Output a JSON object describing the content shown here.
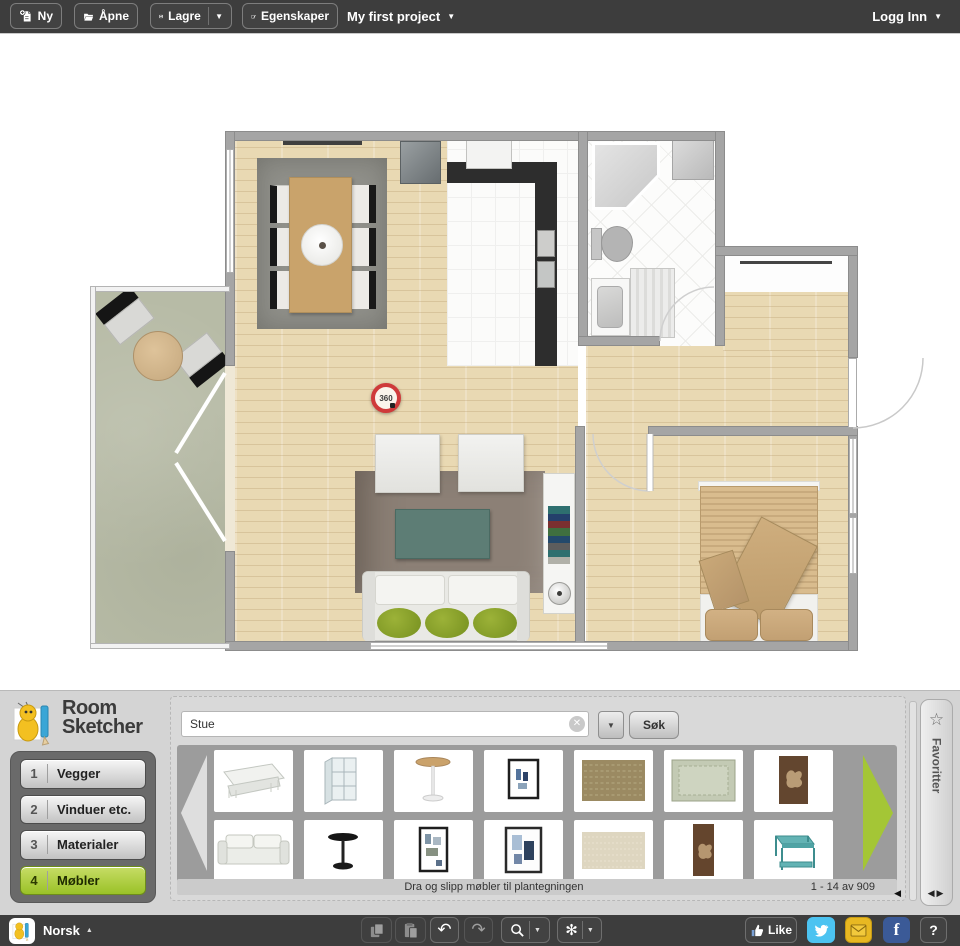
{
  "toolbar": {
    "new_label": "Ny",
    "open_label": "Åpne",
    "save_label": "Lagre",
    "properties_label": "Egenskaper",
    "project_name": "My first project",
    "login_label": "Logg Inn"
  },
  "plan": {
    "marker_360": "360"
  },
  "brand": {
    "name_line1": "Room",
    "name_line2": "Sketcher"
  },
  "menu": {
    "items": [
      {
        "number": "1",
        "label": "Vegger",
        "active": false
      },
      {
        "number": "2",
        "label": "Vinduer etc.",
        "active": false
      },
      {
        "number": "3",
        "label": "Materialer",
        "active": false
      },
      {
        "number": "4",
        "label": "Møbler",
        "active": true
      }
    ]
  },
  "library": {
    "search_value": "Stue",
    "search_button_label": "Søk",
    "drag_hint": "Dra og slipp møbler til plantegningen",
    "result_count": "1 - 14 av 909",
    "favorites_label": "Favoritter",
    "items": [
      {
        "kind": "coffee-table-white"
      },
      {
        "kind": "display-cabinet-white"
      },
      {
        "kind": "pedestal-table-round"
      },
      {
        "kind": "framed-art-figures"
      },
      {
        "kind": "rug-brown-patterned"
      },
      {
        "kind": "rug-green-bordered"
      },
      {
        "kind": "wall-art-flower"
      },
      {
        "kind": "sofa-white"
      },
      {
        "kind": "pedestal-table-black"
      },
      {
        "kind": "framed-art-collage"
      },
      {
        "kind": "framed-art-blue"
      },
      {
        "kind": "rug-beige"
      },
      {
        "kind": "wall-art-flower-tall"
      },
      {
        "kind": "side-table-teal"
      }
    ]
  },
  "statusbar": {
    "language_label": "Norsk",
    "like_label": "Like",
    "help_label": "?"
  },
  "icons": {
    "chevron_down": "▼",
    "chevron_up": "▲",
    "star": "☆",
    "left_small": "◀",
    "right_small": "▶",
    "pair_arrows": "◀▶",
    "undo": "↶",
    "redo": "↷",
    "close": "✕",
    "settings": "✻"
  },
  "colors": {
    "accent_green": "#a4c636",
    "toolbar_bg": "#3d3d3d",
    "twitter_blue": "#4cc3f1",
    "facebook_blue": "#3b5a97",
    "envelope_gold": "#e8b822",
    "marker_red": "#cf3a3a"
  }
}
